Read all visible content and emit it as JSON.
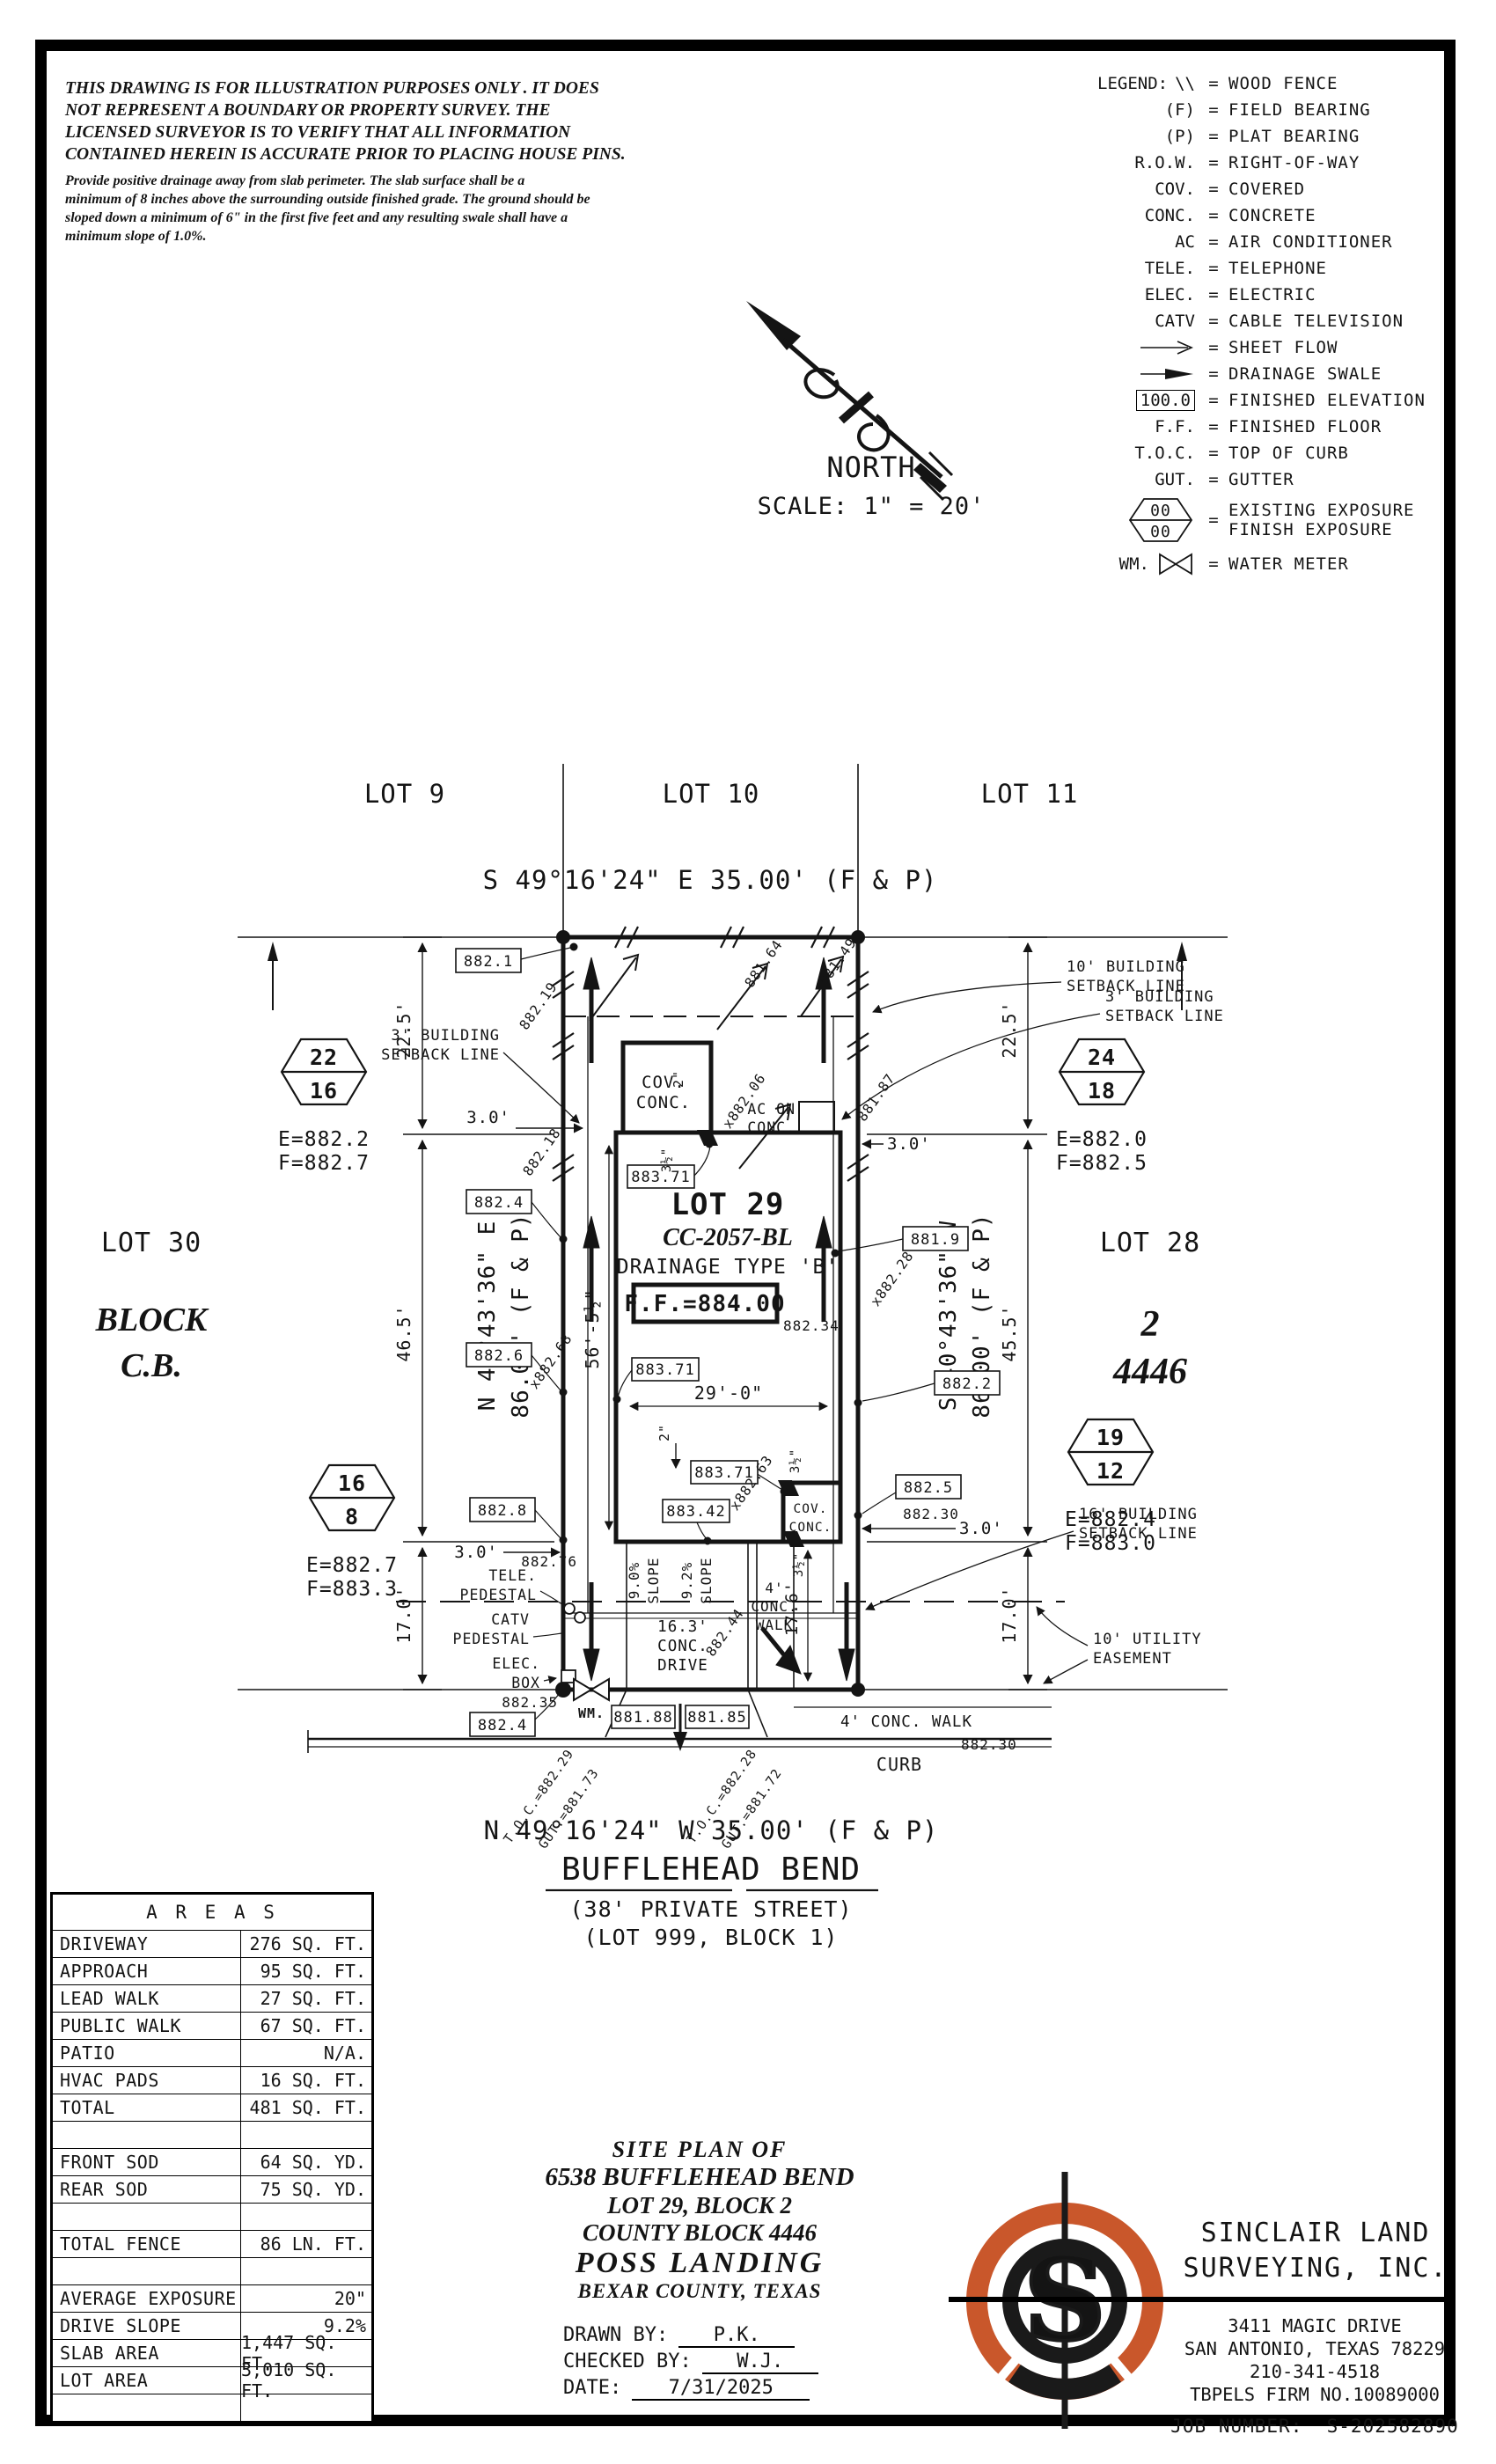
{
  "disclaimer": {
    "l1": "THIS DRAWING IS FOR ILLUSTRATION PURPOSES ONLY . IT DOES",
    "l2": "NOT REPRESENT A BOUNDARY OR PROPERTY SURVEY. THE",
    "l3": "LICENSED SURVEYOR IS TO VERIFY THAT ALL INFORMATION",
    "l4": "CONTAINED HEREIN IS ACCURATE PRIOR TO PLACING HOUSE PINS.",
    "p1": "Provide positive drainage away from slab perimeter. The slab surface shall be a",
    "p2": "minimum of 8 inches above the surrounding outside finished grade. The ground should be",
    "p3": "sloped down a minimum of 6\" in the first five feet and any resulting swale shall have a",
    "p4": "minimum slope of 1.0%."
  },
  "legend": {
    "title": "LEGEND:",
    "eq": "=",
    "items": [
      {
        "sym": "\\\\",
        "label": "WOOD FENCE"
      },
      {
        "sym": "(F)",
        "label": "FIELD BEARING"
      },
      {
        "sym": "(P)",
        "label": "PLAT BEARING"
      },
      {
        "sym": "R.O.W.",
        "label": "RIGHT-OF-WAY"
      },
      {
        "sym": "COV.",
        "label": "COVERED"
      },
      {
        "sym": "CONC.",
        "label": "CONCRETE"
      },
      {
        "sym": "AC",
        "label": "AIR CONDITIONER"
      },
      {
        "sym": "TELE.",
        "label": "TELEPHONE"
      },
      {
        "sym": "ELEC.",
        "label": "ELECTRIC"
      },
      {
        "sym": "CATV",
        "label": "CABLE TELEVISION"
      },
      {
        "sym": "",
        "label": "SHEET FLOW"
      },
      {
        "sym": "",
        "label": "DRAINAGE SWALE"
      },
      {
        "sym": "100.0",
        "label": "FINISHED ELEVATION"
      },
      {
        "sym": "F.F.",
        "label": "FINISHED FLOOR"
      },
      {
        "sym": "T.O.C.",
        "label": "TOP OF CURB"
      },
      {
        "sym": "GUT.",
        "label": "GUTTER"
      },
      {
        "sym": "",
        "hex_top": "00",
        "hex_bot": "00",
        "label": "EXISTING EXPOSURE",
        "label2": "FINISH EXPOSURE"
      },
      {
        "sym": "WM.",
        "label": "WATER METER"
      }
    ]
  },
  "north": {
    "label": "NORTH",
    "scale": "SCALE: 1\" = 20'"
  },
  "plan": {
    "lot9": "LOT 9",
    "lot10": "LOT 10",
    "lot11": "LOT 11",
    "bearing_top": "S 49°16'24\" E 35.00' (F & P)",
    "bearing_bottom": "N 49°16'24\" W 35.00' (F & P)",
    "street": "BUFFLEHEAD BEND",
    "street_sub": "(38' PRIVATE STREET)",
    "street_lot": "(LOT 999, BLOCK 1)",
    "lot30": "LOT 30",
    "block": "BLOCK",
    "cb": "C.B.",
    "lot28": "LOT 28",
    "blk2": "2",
    "cb4446": "4446",
    "lot29": "LOT 29",
    "cc": "CC-2057-BL",
    "drainage": "DRAINAGE TYPE 'B'",
    "ff": "F.F.=884.00",
    "bearing_left1": "N 40°43'36\" E",
    "bearing_left2": "86.00' (F & P)",
    "bearing_right1": "S 40°43'36\" W",
    "bearing_right2": "86.00' (F & P)",
    "hex1_top": "22",
    "hex1_bot": "16",
    "hex1_e": "E=882.2",
    "hex1_f": "F=882.7",
    "hex2_top": "24",
    "hex2_bot": "18",
    "hex2_e": "E=882.0",
    "hex2_f": "F=882.5",
    "hex3_top": "19",
    "hex3_bot": "12",
    "hex3_e": "E=882.4",
    "hex3_f": "F=883.0",
    "hex4_top": "16",
    "hex4_bot": "8",
    "hex4_e": "E=882.7",
    "hex4_f": "F=883.3",
    "bsl3_1": "3' BUILDING",
    "bsl3_2": "SETBACK LINE",
    "bsl10_1": "10' BUILDING",
    "bsl10_2": "SETBACK LINE",
    "bsl16_1": "16' BUILDING",
    "bsl16_2": "SETBACK LINE",
    "ue_1": "10' UTILITY",
    "ue_2": "EASEMENT",
    "d225": "22.5'",
    "d465": "46.5'",
    "d455": "45.5'",
    "d17": "17.0'",
    "d30": "3.0'",
    "d29": "29'-0\"",
    "d56": "56'-5½\"",
    "d176": "17.6'",
    "d2": "2\"",
    "d35": "3½\"",
    "b8821": "882.1",
    "b8824": "882.4",
    "b8826": "882.6",
    "b8828": "882.8",
    "b8819": "881.9",
    "b8822": "882.2",
    "b8825": "882.5",
    "b88371": "883.71",
    "b88342": "883.42",
    "b88188": "881.88",
    "b88185": "881.85",
    "s88219": "882.19",
    "s88164": "881.64",
    "s88149": "881.49",
    "s88206": "x882.06",
    "s88187": "881.87",
    "s88218": "882.18",
    "s88228": "x882.28",
    "s88268": "x882.68",
    "s88276": "882.76",
    "s88263": "x882.63",
    "s88244": "882.44",
    "s88234": "882.34",
    "s88235": "882.35",
    "s88230": "882.30",
    "toc1": "T.O.C.=882.29",
    "gut1": "GUT.=881.73",
    "toc2": "T.O.C.=882.28",
    "gut2": "GUT.=881.72",
    "tele1": "TELE.",
    "tele2": "PEDESTAL",
    "catv1": "CATV",
    "catv2": "PEDESTAL",
    "elec1": "ELEC.",
    "elec2": "BOX",
    "wm": "WM.",
    "curb": "CURB",
    "walk_h": "4' CONC. WALK",
    "drive1": "16.3'",
    "drive2": "CONC.",
    "drive3": "DRIVE",
    "walk1": "4'",
    "walk2": "CONC.",
    "walk3": "WALK",
    "cov": "COV.",
    "conc": "CONC.",
    "ac1": "AC ON",
    "ac2": "CONC.",
    "slope90": "9.0%",
    "slope92": "9.2%",
    "slope": "SLOPE"
  },
  "areas": {
    "title": "A R E A S",
    "rows": [
      {
        "label": "DRIVEWAY",
        "value": "276 SQ. FT."
      },
      {
        "label": "APPROACH",
        "value": "95 SQ. FT."
      },
      {
        "label": "LEAD WALK",
        "value": "27 SQ. FT."
      },
      {
        "label": "PUBLIC WALK",
        "value": "67 SQ. FT."
      },
      {
        "label": "PATIO",
        "value": "N/A."
      },
      {
        "label": "HVAC PADS",
        "value": "16 SQ. FT."
      },
      {
        "label": "TOTAL",
        "value": "481 SQ. FT."
      },
      {
        "label": "",
        "value": ""
      },
      {
        "label": "FRONT SOD",
        "value": "64 SQ. YD."
      },
      {
        "label": "REAR SOD",
        "value": "75 SQ. YD."
      },
      {
        "label": "",
        "value": ""
      },
      {
        "label": "TOTAL FENCE",
        "value": "86 LN. FT."
      },
      {
        "label": "",
        "value": ""
      },
      {
        "label": "AVERAGE EXPOSURE",
        "value": "20\""
      },
      {
        "label": "DRIVE SLOPE",
        "value": "9.2%"
      },
      {
        "label": "SLAB AREA",
        "value": "1,447 SQ. FT."
      },
      {
        "label": "LOT AREA",
        "value": "3,010 SQ. FT."
      },
      {
        "label": "",
        "value": ""
      }
    ]
  },
  "title_block": {
    "l1": "SITE PLAN OF",
    "l2": "6538 BUFFLEHEAD BEND",
    "l3": "LOT 29, BLOCK 2",
    "l4": "COUNTY BLOCK 4446",
    "l5": "POSS LANDING",
    "l6": "BEXAR COUNTY, TEXAS",
    "drawn_label": "DRAWN BY:",
    "drawn": "P.K.",
    "checked_label": "CHECKED BY:",
    "checked": "W.J.",
    "date_label": "DATE:",
    "date": "7/31/2025"
  },
  "firm": {
    "name1": "SINCLAIR LAND",
    "name2": "SURVEYING, INC.",
    "addr1": "3411 MAGIC DRIVE",
    "addr2": "SAN ANTONIO, TEXAS 78229",
    "phone": "210-341-4518",
    "tbpels": "TBPELS FIRM NO.10089000",
    "job_label": "JOB NUMBER:",
    "job": "S-202582890",
    "logo_letter": "S",
    "orange": "#C9572B"
  }
}
